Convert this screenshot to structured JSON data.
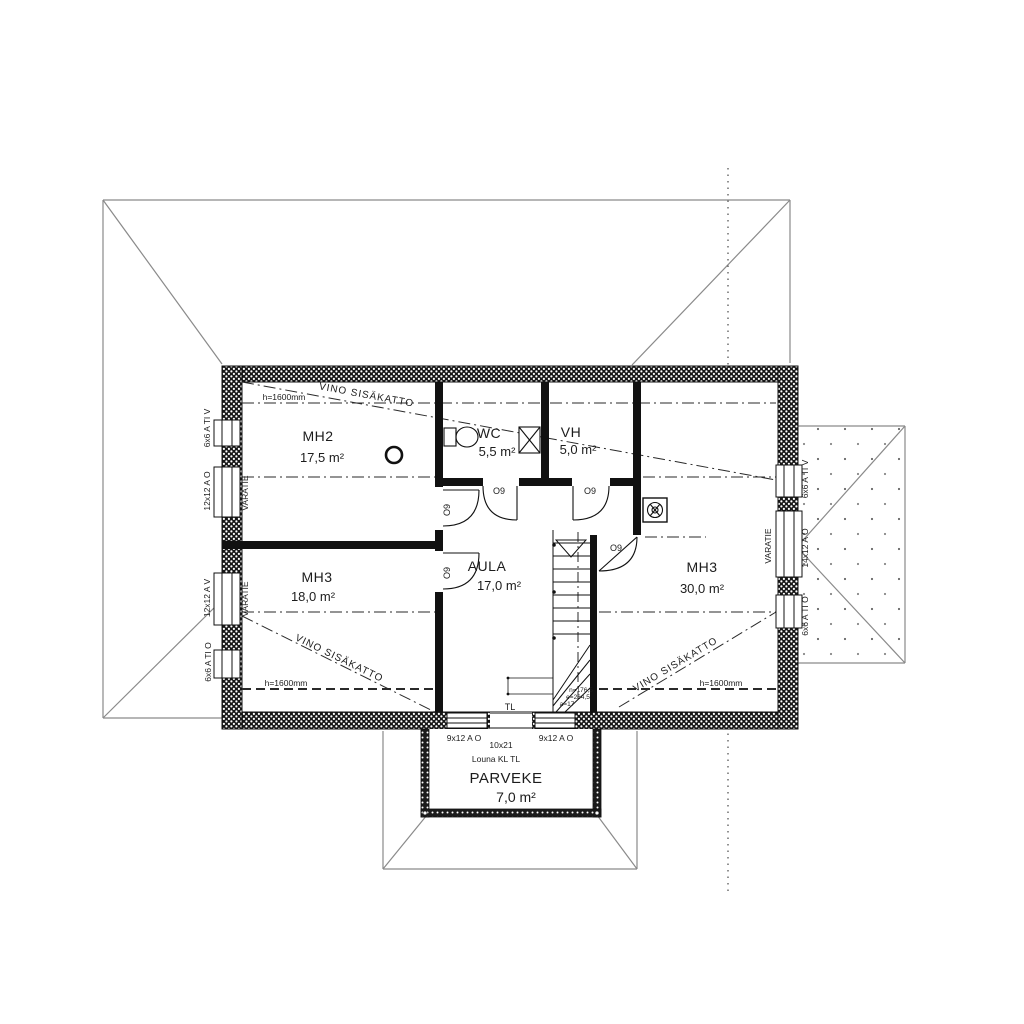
{
  "rooms": {
    "mh2": {
      "name": "MH2",
      "area": "17,5 m²"
    },
    "wc": {
      "name": "WC",
      "area": "5,5 m²"
    },
    "vh": {
      "name": "VH",
      "area": "5,0 m²"
    },
    "aula": {
      "name": "AULA",
      "area": "17,0 m²"
    },
    "mh3_left": {
      "name": "MH3",
      "area": "18,0 m²"
    },
    "mh3_right": {
      "name": "MH3",
      "area": "30,0 m²"
    },
    "parveke": {
      "name": "PARVEKE",
      "area": "7,0 m²"
    }
  },
  "ceiling": {
    "slope_label": "VINO SISÄKATTO",
    "height_label": "h=1600mm"
  },
  "doors": {
    "code": "O9",
    "balcony_door_size": "10x21",
    "balcony_door_model": "Louna KL TL",
    "hatch_label": "TL"
  },
  "windows": {
    "left": [
      "6x6 A TI V",
      "12x12 A O",
      "12x12 A V",
      "6x6 A TI O"
    ],
    "right": [
      "6x6 A TI V",
      "14x12 A O",
      "6x6 A TI O"
    ],
    "bottom": [
      "9x12 A O",
      "9x12 A O"
    ],
    "escape_label": "VARATIE"
  },
  "stairs": {
    "dims": [
      "n=176,5",
      "e=264,5",
      "a=17"
    ]
  }
}
